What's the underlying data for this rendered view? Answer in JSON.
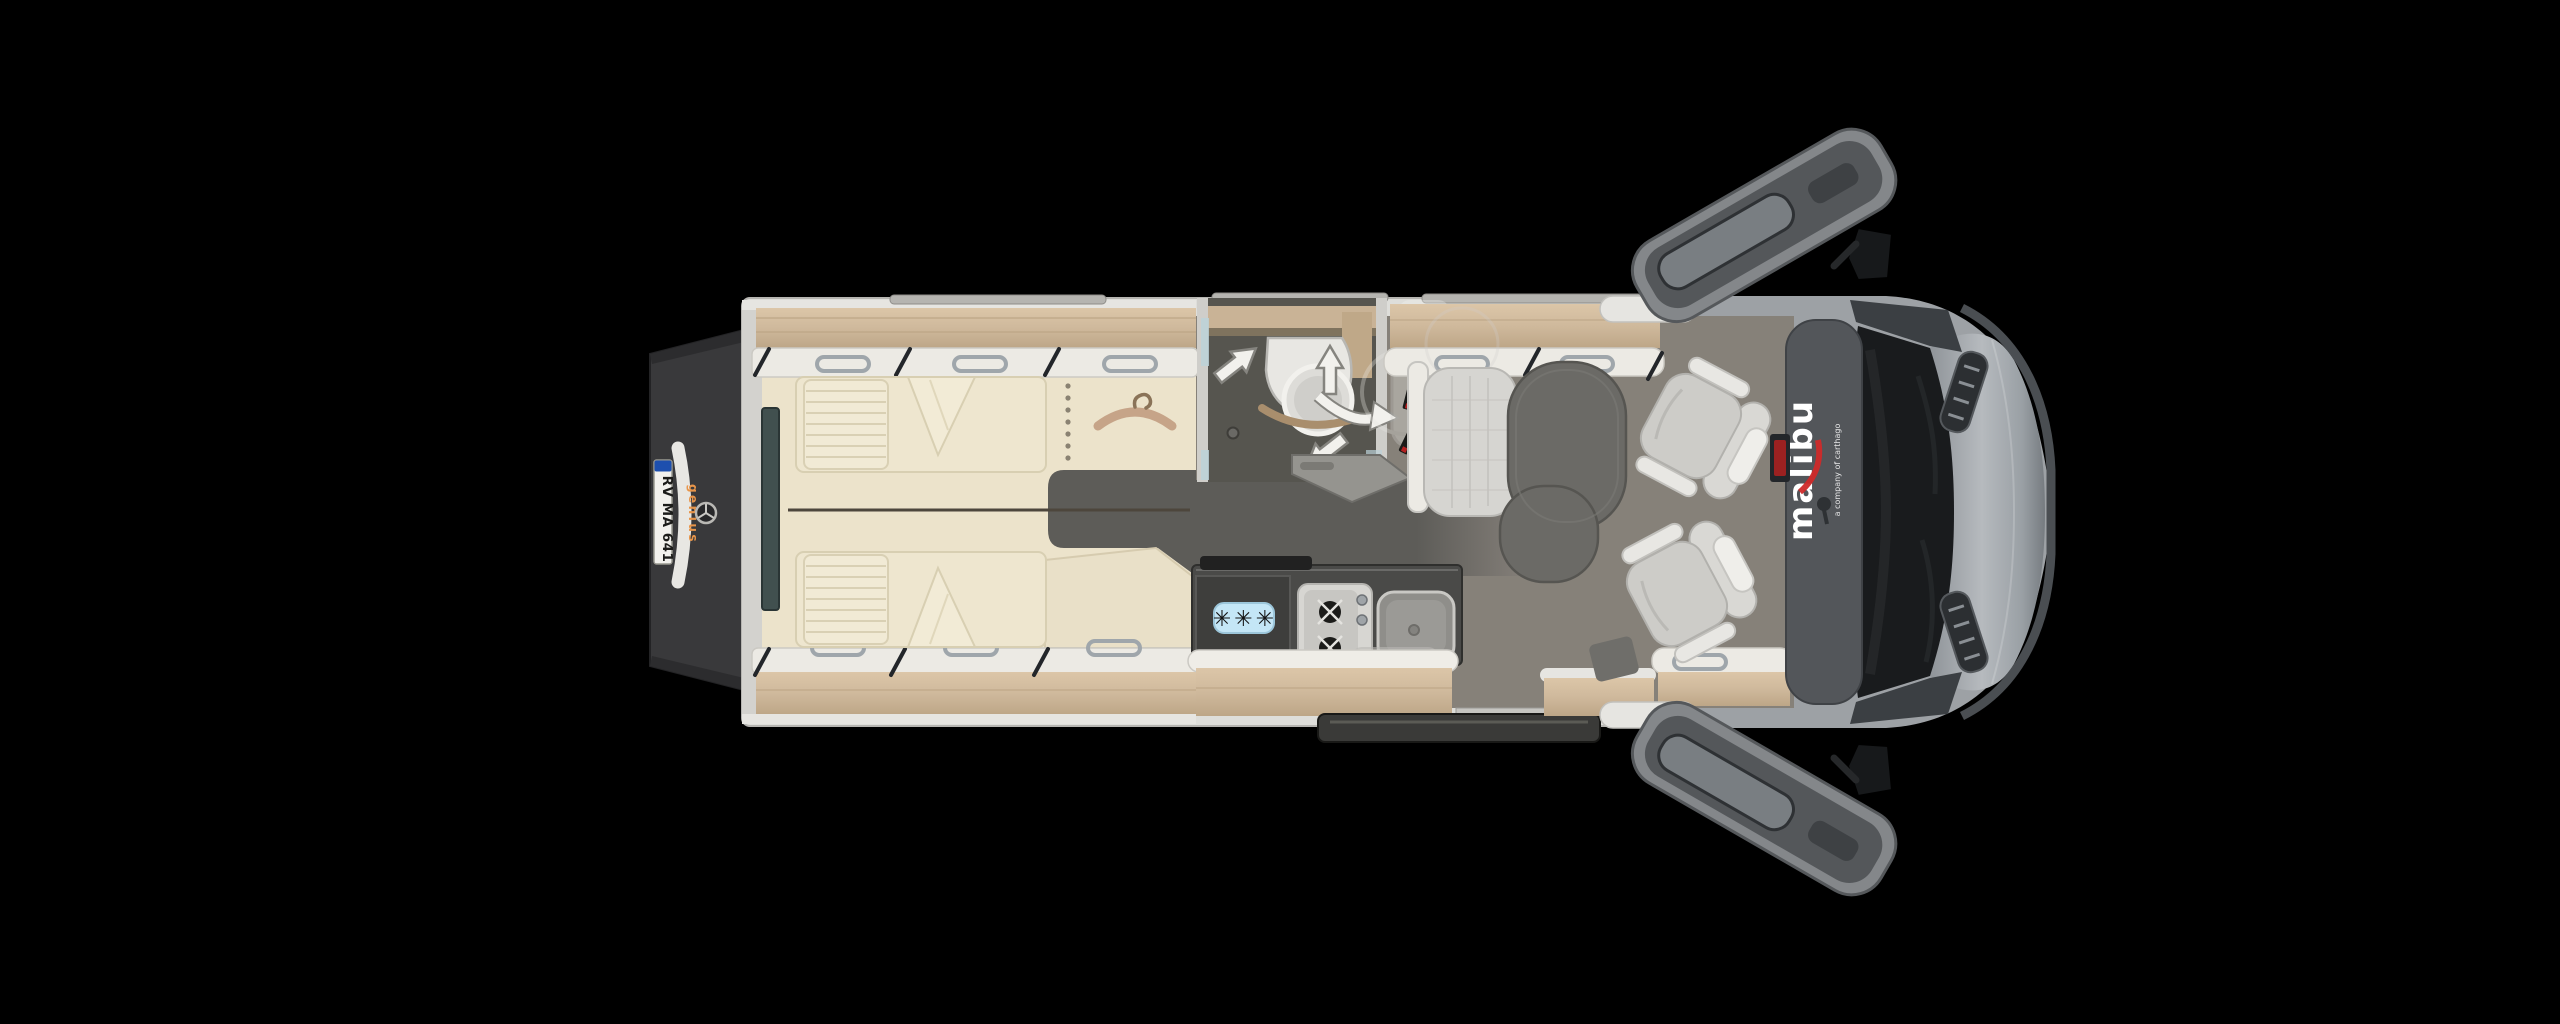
{
  "scene": {
    "description": "Top-down floor plan render of a Malibu camper van with twin rear beds, rear wardrobe, swivel-basin bathroom, kitchen block and front dinette with swivelled cab seats, shown on a black background with both cab doors open",
    "background_color": "#000000"
  },
  "branding": {
    "roof_logo": "malibu",
    "roof_tagline": "a company of carthago",
    "roof_logo_color": "#ffffff",
    "roof_accent_color": "#cf2a2a",
    "rear_logo": "genius",
    "rear_logo_color": "#e8954a",
    "rear_emblem": "mercedes-star"
  },
  "license_plate": {
    "text": "RV MA 641",
    "plate_color": "#f2f1ed",
    "eu_band_color": "#1d4fae",
    "text_color": "#1c1c1a"
  },
  "kitchen": {
    "fridge_badge": "✳✳✳",
    "fridge_badge_bg": "#c4e6f6",
    "burner_count": 2
  },
  "zones": [
    "rear-twin-beds",
    "wardrobe",
    "bathroom-with-swivel-basin",
    "kitchen-block",
    "dinette-with-table",
    "cab-with-swivel-seats"
  ],
  "icons": {
    "mercedes-star-icon": "three-pointed star in ring",
    "clothes-hanger-icon": "curved wooden hanger with hook",
    "snowflake-badge-icon": "✳✳✳",
    "move-arrow-icon": "straight white arrow",
    "swivel-arrow-icon": "curved white arrow",
    "shower-drain-icon": "small circle",
    "mirror-icon": "black side mirror wing"
  },
  "colors": {
    "wood": "#cfb99c",
    "wood_dark": "#b49c7c",
    "wall": "#e6e5e1",
    "mattress": "#ece3cb",
    "floor_corridor": "#5d5c58",
    "floor_lounge": "#868179",
    "counter": "#4a4a48",
    "cab_body": "#a3a7ab",
    "windshield": "#191b1d",
    "roof_band": "#53565a",
    "rear_door": "#39393b",
    "seat": "#cdccc8",
    "table": "#6b6a66"
  }
}
